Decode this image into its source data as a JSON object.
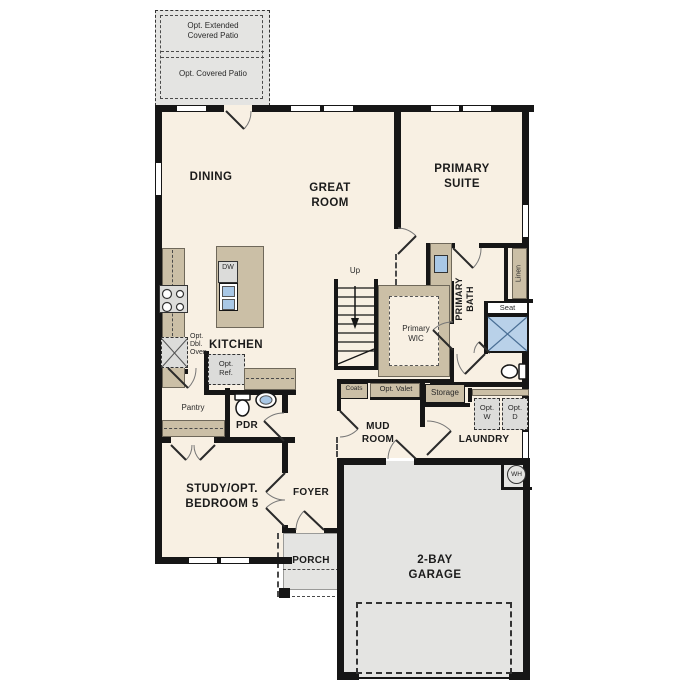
{
  "patio": {
    "extended_label": "Opt. Extended Covered Patio",
    "covered_label": "Opt. Covered Patio"
  },
  "rooms": {
    "dining": "DINING",
    "great_room": "GREAT ROOM",
    "primary_suite": "PRIMARY SUITE",
    "kitchen": "KITCHEN",
    "pantry": "Pantry",
    "powder_room": "PDR",
    "study": "STUDY/OPT. BEDROOM 5",
    "foyer": "FOYER",
    "porch": "PORCH",
    "garage": "2-BAY GARAGE",
    "mud_room": "MUD ROOM",
    "laundry": "LAUNDRY",
    "primary_wic": "Primary WIC",
    "primary_bath": "PRIMARY BATH"
  },
  "features": {
    "stairs_up": "Up",
    "dishwasher": "DW",
    "opt_double_oven": "Opt. Dbl. Oven",
    "opt_refrigerator": "Opt. Ref.",
    "coats": "Coats",
    "opt_valet": "Opt. Valet",
    "storage": "Storage",
    "opt_washer": "Opt. W",
    "opt_dryer": "Opt. D",
    "linen": "Linen",
    "seat": "Seat",
    "water_heater": "WH"
  },
  "colors": {
    "wall": "#161616",
    "floor": "#f8f0e3",
    "cabinetry": "#cbbfa6",
    "concrete": "#e4e4e2",
    "fixture_blue": "#a9c8e6"
  }
}
